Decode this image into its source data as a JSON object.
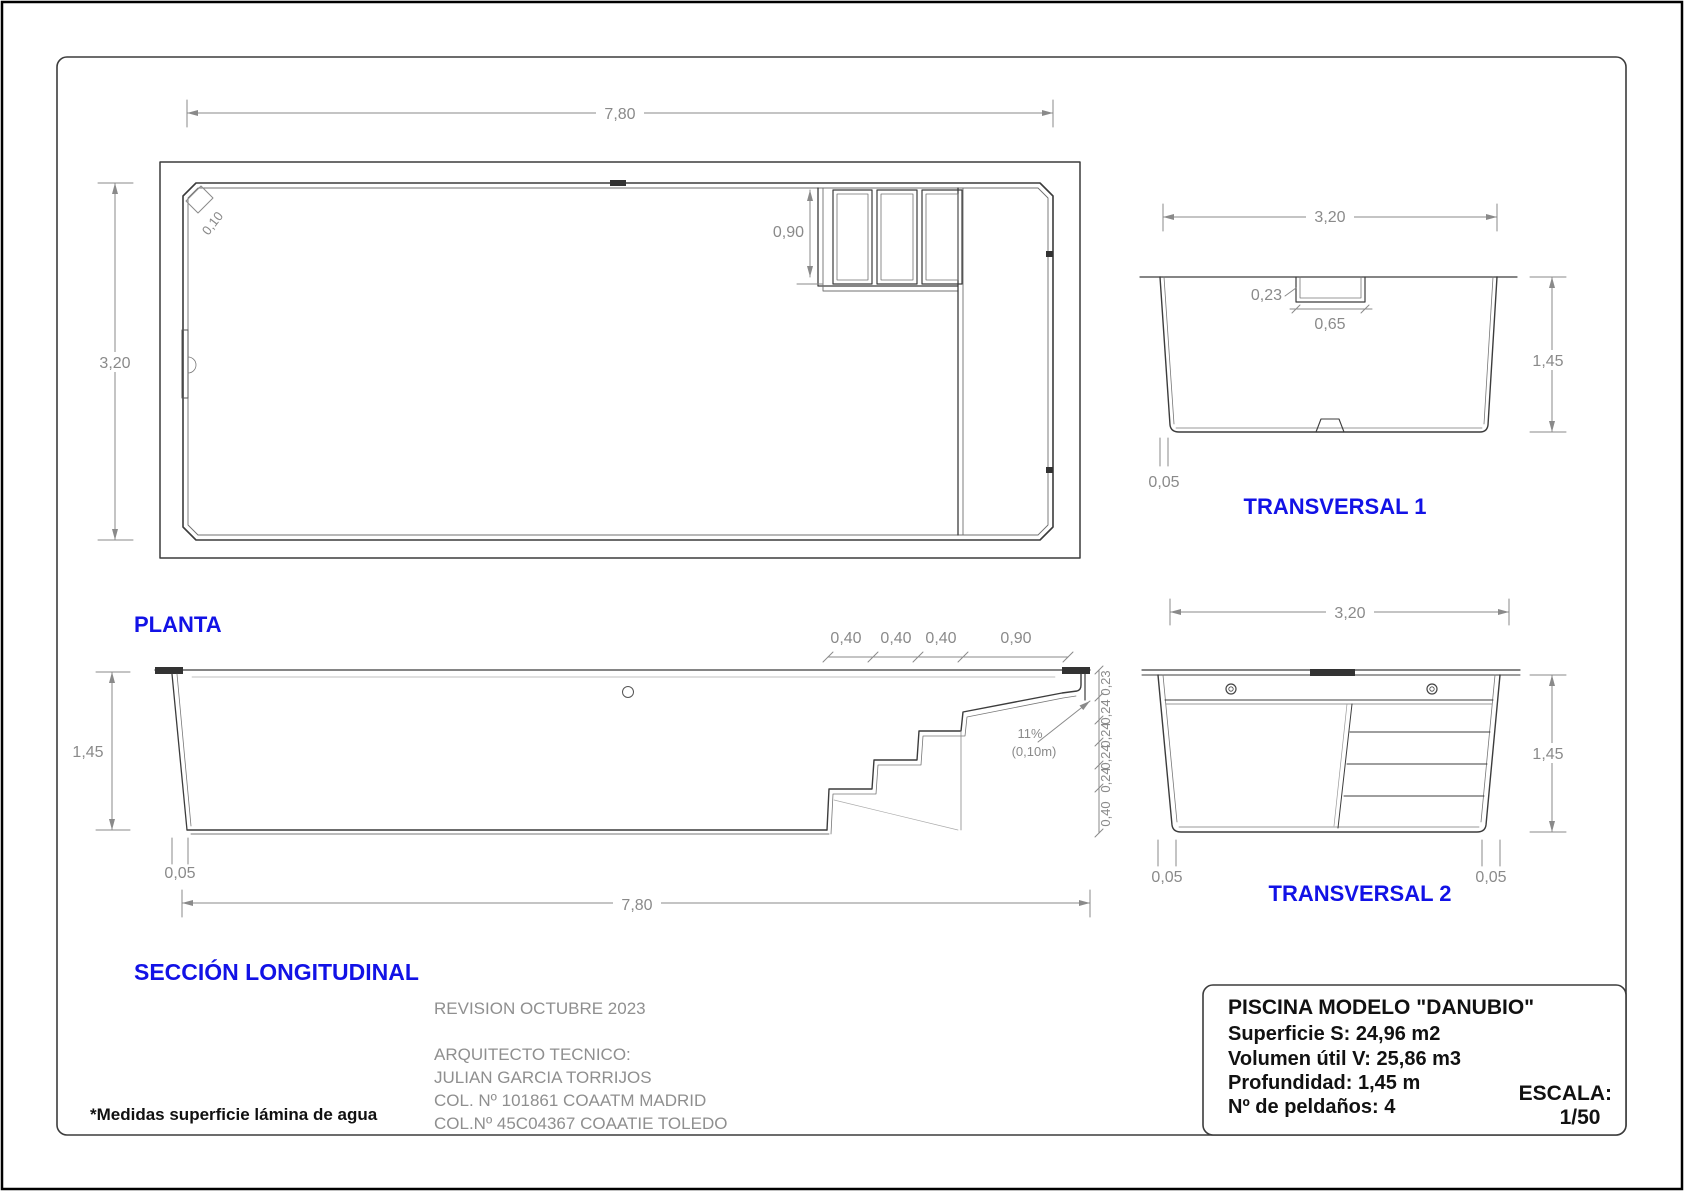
{
  "page": {
    "background": "#ffffff",
    "line_color": "#3c3c3c",
    "dim_color": "#8a8a8a",
    "accent_blue": "#1212e6"
  },
  "views": {
    "planta": {
      "title": "PLANTA",
      "dims": {
        "width_top": "7,80",
        "height_left": "3,20",
        "steps_depth": "0,90",
        "corner_chamfer": "0,10"
      }
    },
    "transversal1": {
      "title": "TRANSVERSAL 1",
      "dims": {
        "width_top": "3,20",
        "recess_depth": "0,23",
        "recess_width": "0,65",
        "depth_right": "1,45",
        "wall_bottom": "0,05"
      }
    },
    "longitudinal": {
      "title": "SECCIÓN LONGITUDINAL",
      "dims": {
        "depth_left": "1,45",
        "wall_left": "0,05",
        "length_bottom": "7,80",
        "tread_1": "0,40",
        "tread_2": "0,40",
        "tread_3": "0,40",
        "tread_4": "0,90",
        "riser_chain": [
          "0,23",
          "0,24",
          "0,24",
          "0,24",
          "0,24",
          "0,40"
        ],
        "slope_note_line1": "11%",
        "slope_note_line2": "(0,10m)"
      }
    },
    "transversal2": {
      "title": "TRANSVERSAL 2",
      "dims": {
        "width_top": "3,20",
        "depth_right": "1,45",
        "wall_left": "0,05",
        "wall_right": "0,05"
      }
    }
  },
  "notes": {
    "revision": "REVISION OCTUBRE 2023",
    "architect_label": "ARQUITECTO TECNICO:",
    "architect_name": "JULIAN GARCIA TORRIJOS",
    "college_1": "COL. Nº 101861 COAATM MADRID",
    "college_2": "COL.Nº 45C04367 COAATIE TOLEDO",
    "measures_note": "*Medidas superficie lámina de agua"
  },
  "title_block": {
    "model": "PISCINA MODELO \"DANUBIO\"",
    "surface": "Superficie S: 24,96 m2",
    "volume": "Volumen útil V: 25,86 m3",
    "depth": "Profundidad: 1,45 m",
    "steps": "Nº de peldaños: 4",
    "scale_label": "ESCALA:",
    "scale_value": "1/50"
  }
}
